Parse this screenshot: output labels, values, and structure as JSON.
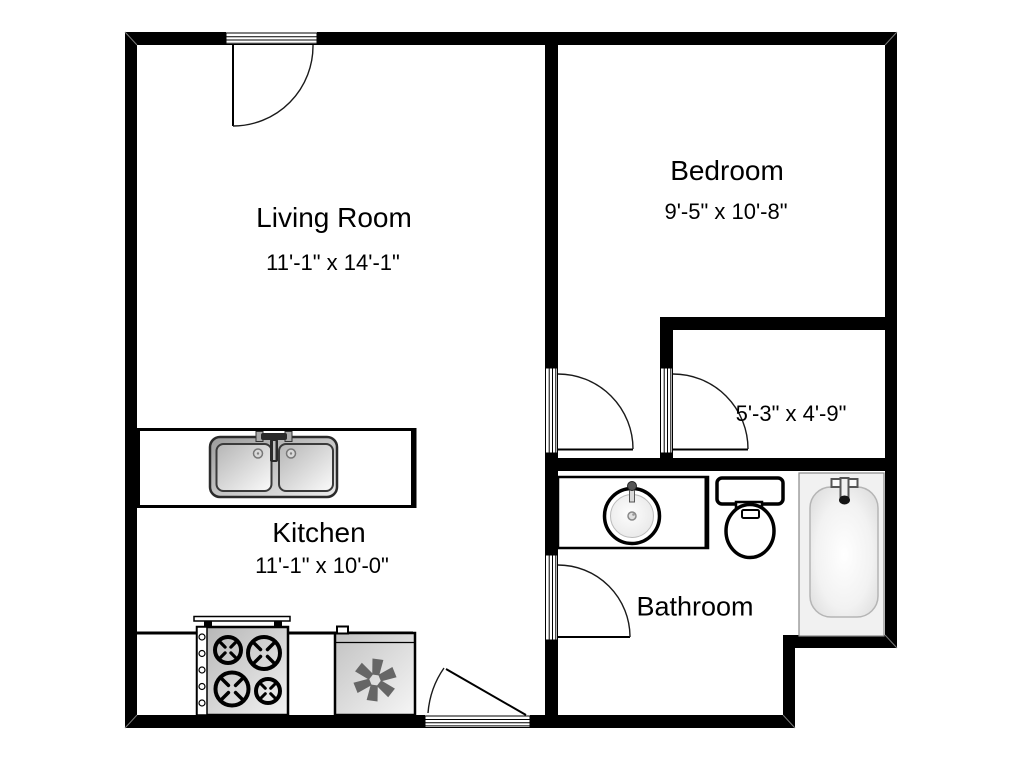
{
  "rooms": {
    "living_room": {
      "name": "Living Room",
      "dims": "11'-1\" x 14'-1\""
    },
    "bedroom": {
      "name": "Bedroom",
      "dims": "9'-5\" x 10'-8\""
    },
    "kitchen": {
      "name": "Kitchen",
      "dims": "11'-1\" x 10'-0\""
    },
    "closet": {
      "dims": "5'-3\" x 4'-9\""
    },
    "bathroom": {
      "name": "Bathroom"
    }
  },
  "fixtures": {
    "kitchen_sink": "double-basin-sink",
    "stove": "four-burner-stove",
    "refrigerator": "refrigerator-snowflake",
    "vanity_sink": "round-vanity-sink",
    "toilet": "toilet",
    "bathtub": "bathtub"
  },
  "doors": [
    "living-room-entry-door",
    "bedroom-door",
    "closet-door",
    "bathroom-door",
    "kitchen-entry-door"
  ],
  "colors": {
    "wall": "#000000",
    "background": "#ffffff",
    "appliance_dark": "#a8a8a8",
    "appliance_light": "#f5f5f5",
    "snowflake": "#666666",
    "door_arc": "#1a1a1a"
  }
}
